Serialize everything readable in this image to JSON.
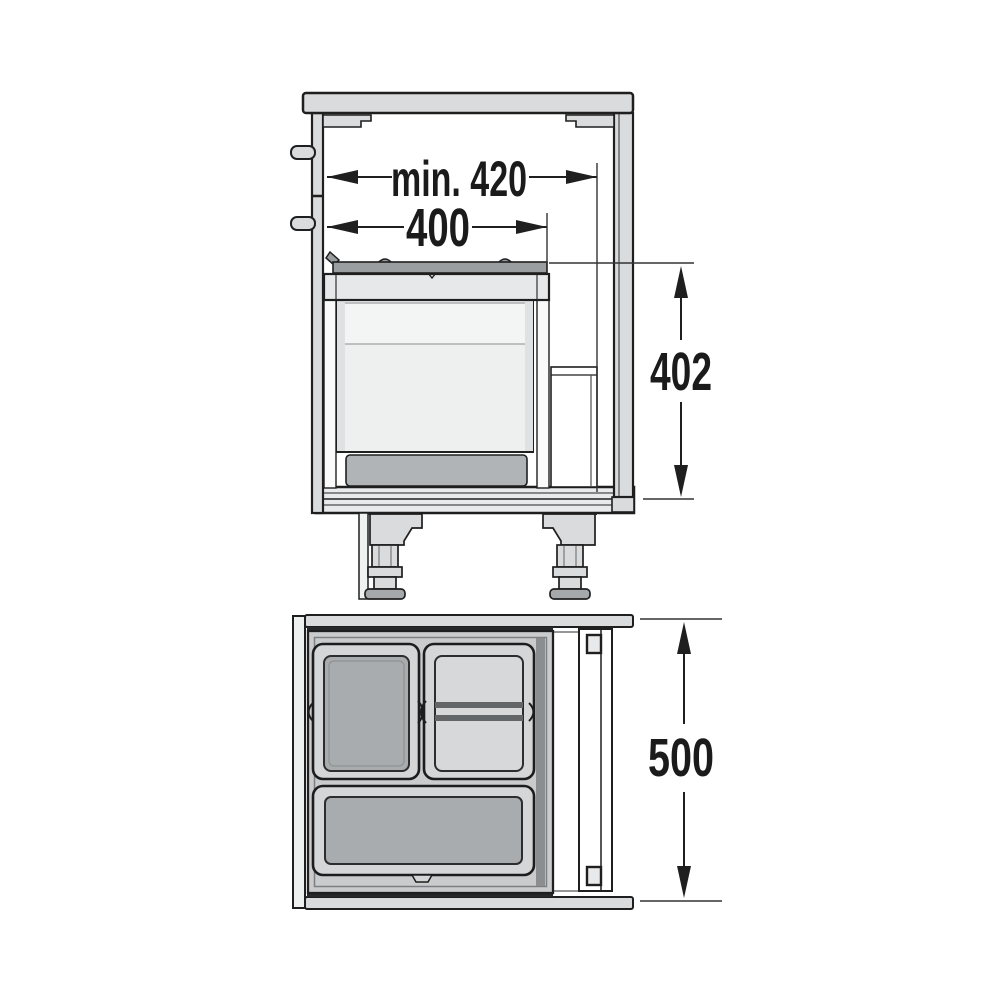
{
  "side_view": {
    "dim_interior_width": "min. 420",
    "dim_bin_width": "400",
    "dim_height": "402"
  },
  "plan_view": {
    "dim_depth": "500"
  },
  "colors": {
    "line": "#1f1f1f",
    "panel_gray": "#d9dbdc",
    "bin_light": "#eef0f0",
    "bin_band": "#f3f4f4",
    "bin_dark": "#a9acae",
    "frame_gray": "#c9cbcc",
    "rim_gray": "#e7e8e9",
    "base_gray": "#b1b4b6",
    "lid_gray": "#9b9ea0",
    "plan_bin_rim": "#d4d6d7",
    "plan_bin_inner_light": "#d6d8d9",
    "divider_dark": "#636668",
    "platform_gray": "#e9eaeb",
    "rail_white": "#fafafa"
  }
}
